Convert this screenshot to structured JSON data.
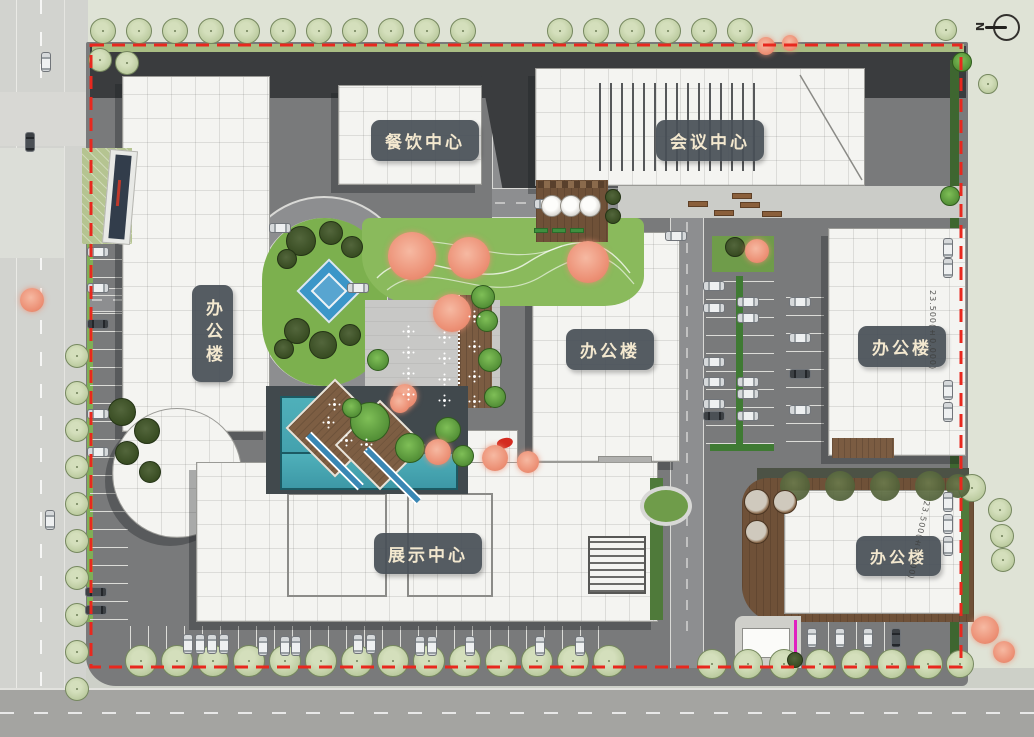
{
  "north": {
    "label": "N"
  },
  "buildings": {
    "dining": {
      "label": "餐饮中心"
    },
    "conference": {
      "label": "会议中心"
    },
    "office_left": {
      "label": "办公楼"
    },
    "office_mid": {
      "label": "办公楼"
    },
    "office_right": {
      "label": "办公楼"
    },
    "office_br": {
      "label": "办公楼"
    },
    "exhibition": {
      "label": "展示中心"
    }
  },
  "annotations": {
    "elev_right": "23.500(±0.000)",
    "elev_br": "23.500(±0.000)"
  },
  "colors": {
    "boundary_red": "#e8281e",
    "label_bg": "#485057",
    "label_text": "#f3e8cf",
    "site_asphalt": "#797a7b",
    "outside_bg": "#dfe3d6",
    "street": "#d2d3cf",
    "building_white": "#f4f4f1",
    "roof_dark": "#3a3c3e",
    "lawn_green": "#7cb04e",
    "tree_pale": "#c3d1a8",
    "tree_dark": "#35491f",
    "tree_orange": "#ec8f74",
    "water_teal": "#3d98a6",
    "fountain_blue": "#3b96c8",
    "deck_brown": "#7b5c42",
    "hedge_green": "#3e6630"
  },
  "features": {
    "trees": {
      "pale": [
        [
          103,
          31,
          13
        ],
        [
          139,
          31,
          13
        ],
        [
          175,
          31,
          13
        ],
        [
          211,
          31,
          13
        ],
        [
          247,
          31,
          13
        ],
        [
          283,
          31,
          13
        ],
        [
          319,
          31,
          13
        ],
        [
          355,
          31,
          13
        ],
        [
          391,
          31,
          13
        ],
        [
          427,
          31,
          13
        ],
        [
          463,
          31,
          13
        ],
        [
          560,
          31,
          13
        ],
        [
          596,
          31,
          13
        ],
        [
          632,
          31,
          13
        ],
        [
          668,
          31,
          13
        ],
        [
          704,
          31,
          13
        ],
        [
          740,
          31,
          13
        ],
        [
          946,
          30,
          11
        ],
        [
          988,
          84,
          10
        ],
        [
          100,
          60,
          12
        ],
        [
          127,
          63,
          12
        ],
        [
          77,
          356,
          12
        ],
        [
          77,
          393,
          12
        ],
        [
          77,
          430,
          12
        ],
        [
          77,
          467,
          12
        ],
        [
          77,
          504,
          12
        ],
        [
          77,
          541,
          12
        ],
        [
          77,
          578,
          12
        ],
        [
          77,
          615,
          12
        ],
        [
          77,
          652,
          12
        ],
        [
          77,
          689,
          12
        ],
        [
          141,
          661,
          16
        ],
        [
          177,
          661,
          16
        ],
        [
          213,
          661,
          16
        ],
        [
          249,
          661,
          16
        ],
        [
          285,
          661,
          16
        ],
        [
          321,
          661,
          16
        ],
        [
          357,
          661,
          16
        ],
        [
          393,
          661,
          16
        ],
        [
          429,
          661,
          16
        ],
        [
          465,
          661,
          16
        ],
        [
          501,
          661,
          16
        ],
        [
          537,
          661,
          16
        ],
        [
          573,
          661,
          16
        ],
        [
          609,
          661,
          16
        ],
        [
          712,
          664,
          15
        ],
        [
          748,
          664,
          15
        ],
        [
          784,
          664,
          15
        ],
        [
          820,
          664,
          15
        ],
        [
          856,
          664,
          15
        ],
        [
          892,
          664,
          15
        ],
        [
          928,
          664,
          15
        ],
        [
          960,
          664,
          14
        ],
        [
          1000,
          510,
          12
        ],
        [
          1002,
          536,
          12
        ],
        [
          1003,
          560,
          12
        ],
        [
          972,
          488,
          14
        ]
      ],
      "dark": [
        [
          122,
          412,
          14
        ],
        [
          147,
          431,
          13
        ],
        [
          127,
          453,
          12
        ],
        [
          150,
          472,
          11
        ],
        [
          301,
          241,
          15
        ],
        [
          331,
          233,
          12
        ],
        [
          352,
          247,
          11
        ],
        [
          287,
          259,
          10
        ],
        [
          297,
          331,
          13
        ],
        [
          323,
          345,
          14
        ],
        [
          350,
          335,
          11
        ],
        [
          284,
          349,
          10
        ],
        [
          735,
          247,
          10
        ],
        [
          613,
          197,
          8
        ],
        [
          613,
          216,
          8
        ],
        [
          795,
          660,
          8
        ]
      ],
      "olive": [
        [
          795,
          486,
          15
        ],
        [
          840,
          486,
          15
        ],
        [
          885,
          486,
          15
        ],
        [
          930,
          486,
          15
        ],
        [
          958,
          486,
          12
        ]
      ],
      "bright": [
        [
          370,
          422,
          20
        ],
        [
          410,
          448,
          15
        ],
        [
          352,
          408,
          10
        ],
        [
          448,
          430,
          13
        ],
        [
          463,
          456,
          11
        ],
        [
          483,
          297,
          12
        ],
        [
          487,
          321,
          11
        ],
        [
          490,
          360,
          12
        ],
        [
          495,
          397,
          11
        ],
        [
          378,
          360,
          11
        ],
        [
          950,
          196,
          10
        ],
        [
          962,
          62,
          10
        ]
      ],
      "orange": [
        [
          412,
          256,
          24
        ],
        [
          469,
          258,
          21
        ],
        [
          588,
          262,
          21
        ],
        [
          452,
          313,
          19
        ],
        [
          405,
          396,
          12
        ],
        [
          400,
          403,
          10
        ],
        [
          438,
          452,
          13
        ],
        [
          495,
          458,
          13
        ],
        [
          528,
          462,
          11
        ],
        [
          757,
          251,
          12
        ],
        [
          32,
          300,
          12
        ],
        [
          985,
          630,
          14
        ],
        [
          1004,
          652,
          11
        ],
        [
          766,
          46,
          9
        ],
        [
          790,
          43,
          8
        ]
      ]
    },
    "cars": {
      "h_light": [
        [
          98,
          252
        ],
        [
          98,
          288
        ],
        [
          98,
          414
        ],
        [
          98,
          452
        ],
        [
          280,
          228
        ],
        [
          358,
          288
        ],
        [
          545,
          204
        ],
        [
          676,
          236
        ],
        [
          714,
          286
        ],
        [
          748,
          302
        ],
        [
          714,
          308
        ],
        [
          748,
          318
        ],
        [
          714,
          362
        ],
        [
          714,
          382
        ],
        [
          748,
          382
        ],
        [
          748,
          394
        ],
        [
          714,
          404
        ],
        [
          748,
          416
        ],
        [
          800,
          302
        ],
        [
          800,
          338
        ],
        [
          800,
          410
        ]
      ],
      "h_dark": [
        [
          98,
          324
        ],
        [
          96,
          592
        ],
        [
          96,
          610
        ],
        [
          714,
          416
        ],
        [
          800,
          374
        ]
      ],
      "v_light": [
        [
          948,
          248
        ],
        [
          948,
          268
        ],
        [
          948,
          390
        ],
        [
          948,
          412
        ],
        [
          948,
          502
        ],
        [
          948,
          524
        ],
        [
          948,
          546
        ],
        [
          812,
          638
        ],
        [
          840,
          638
        ],
        [
          868,
          638
        ],
        [
          188,
          644
        ],
        [
          200,
          644
        ],
        [
          212,
          644
        ],
        [
          224,
          644
        ],
        [
          263,
          646
        ],
        [
          285,
          646
        ],
        [
          296,
          646
        ],
        [
          358,
          644
        ],
        [
          371,
          644
        ],
        [
          420,
          646
        ],
        [
          432,
          646
        ],
        [
          470,
          646
        ],
        [
          540,
          646
        ],
        [
          580,
          646
        ],
        [
          46,
          62
        ],
        [
          50,
          520
        ]
      ],
      "v_dark": [
        [
          896,
          638
        ],
        [
          30,
          142
        ]
      ]
    },
    "tables": [
      [
        408,
        331
      ],
      [
        408,
        352
      ],
      [
        408,
        373
      ],
      [
        408,
        394
      ],
      [
        444,
        337
      ],
      [
        444,
        358
      ],
      [
        444,
        379
      ],
      [
        444,
        400
      ],
      [
        474,
        316
      ],
      [
        474,
        346
      ],
      [
        474,
        376
      ],
      [
        474,
        401
      ],
      [
        328,
        422
      ],
      [
        346,
        440
      ],
      [
        366,
        444
      ],
      [
        334,
        404
      ]
    ],
    "benches": [
      [
        698,
        204
      ],
      [
        724,
        213
      ],
      [
        750,
        205
      ],
      [
        772,
        214
      ],
      [
        742,
        196
      ]
    ],
    "umbrellas": [
      [
        552,
        206
      ],
      [
        571,
        206
      ],
      [
        590,
        206
      ]
    ],
    "planters": [
      [
        757,
        502,
        13
      ],
      [
        785,
        502,
        12
      ],
      [
        757,
        532,
        12
      ]
    ],
    "green_benches": [
      [
        541,
        230
      ],
      [
        559,
        230
      ],
      [
        577,
        230
      ]
    ]
  }
}
